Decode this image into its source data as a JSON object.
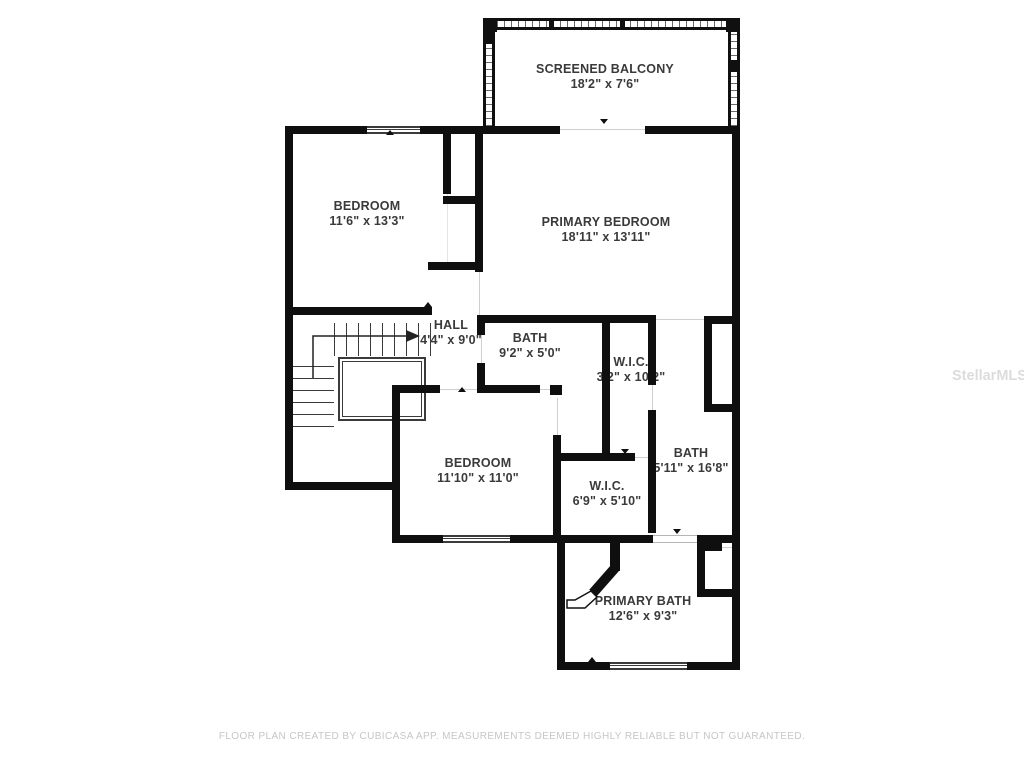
{
  "floorplan": {
    "rooms": [
      {
        "id": "screened-balcony",
        "name": "SCREENED BALCONY",
        "dims": "18'2\" x 7'6\""
      },
      {
        "id": "bedroom-1",
        "name": "BEDROOM",
        "dims": "11'6\" x 13'3\""
      },
      {
        "id": "primary-bedroom",
        "name": "PRIMARY BEDROOM",
        "dims": "18'11\" x 13'11\""
      },
      {
        "id": "hall",
        "name": "HALL",
        "dims": "4'4\" x 9'0\""
      },
      {
        "id": "bath-1",
        "name": "BATH",
        "dims": "9'2\" x 5'0\""
      },
      {
        "id": "wic-1",
        "name": "W.I.C.",
        "dims": "3'2\" x 10'2\""
      },
      {
        "id": "bedroom-2",
        "name": "BEDROOM",
        "dims": "11'10\" x 11'0\""
      },
      {
        "id": "bath-2",
        "name": "BATH",
        "dims": "5'11\" x 16'8\""
      },
      {
        "id": "wic-2",
        "name": "W.I.C.",
        "dims": "6'9\" x 5'10\""
      },
      {
        "id": "primary-bath",
        "name": "PRIMARY BATH",
        "dims": "12'6\" x 9'3\""
      }
    ],
    "watermark": "StellarMLS",
    "footer": "FLOOR PLAN CREATED BY CUBICASA APP. MEASUREMENTS DEEMED HIGHLY RELIABLE BUT NOT GUARANTEED.",
    "colors": {
      "wall": "#0f0f0f",
      "label_text": "#3a3a3a",
      "footer_text": "#c6c6c6",
      "watermark_text": "#dcdcdc"
    }
  }
}
